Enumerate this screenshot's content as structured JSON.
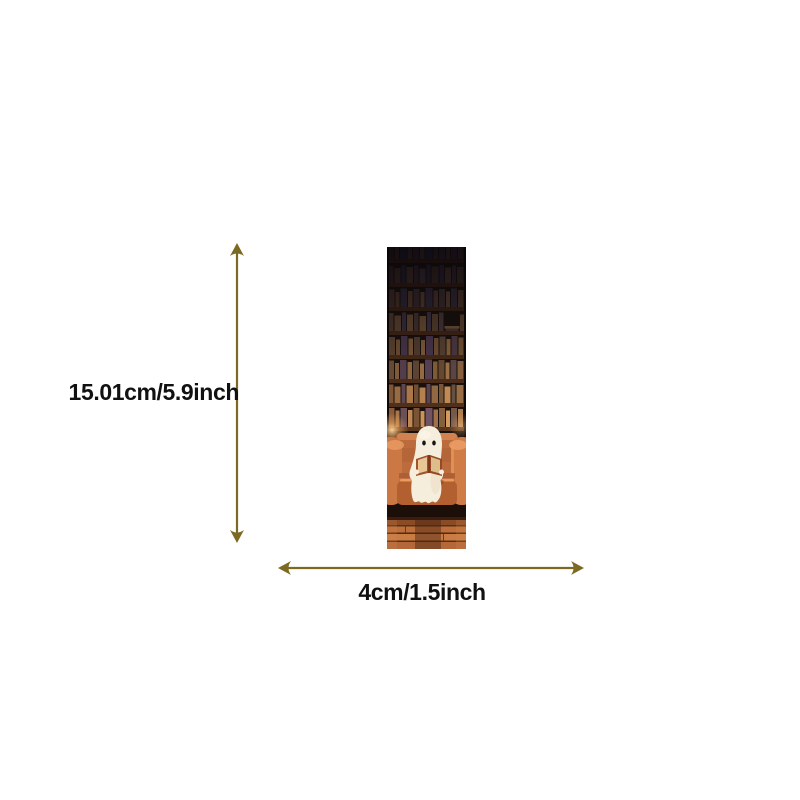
{
  "diagram": {
    "height_label": "15.01cm/5.9inch",
    "width_label": "4cm/1.5inch",
    "arrow_color": "#7d6a22",
    "label_color": "#111111",
    "background_color": "#ffffff"
  },
  "bookmark": {
    "description": "bookmark art: cute white ghost reading an open book while sitting on an orange couch in front of a tall dark bookshelf, warm lamp glow, wooden floor",
    "colors": {
      "shelf_dark": "#17100d",
      "couch_orange": "#bc6c3c",
      "ghost_cream": "#f6eedd",
      "book_rust": "#a5512a",
      "floor_wood": "#a35c2e"
    }
  }
}
